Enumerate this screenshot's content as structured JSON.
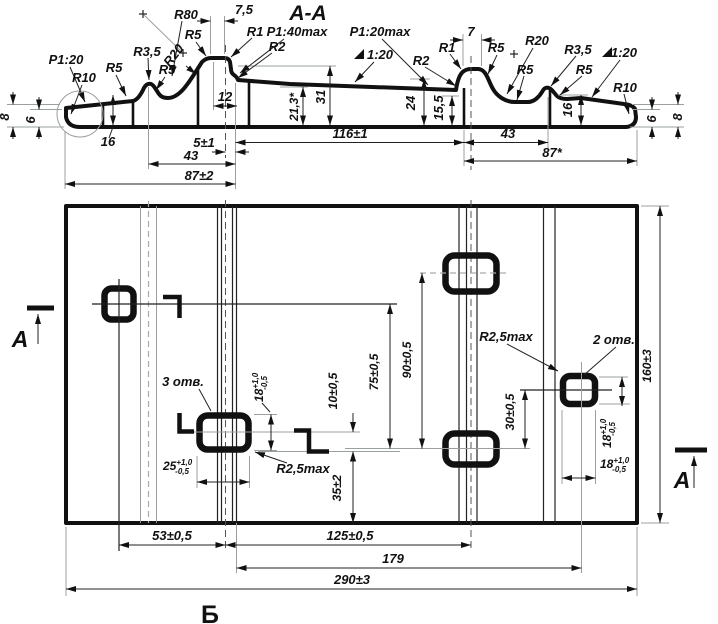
{
  "drawing": {
    "type": "engineering-drawing",
    "section_title": "A-A",
    "bottom_view_letter": "Б",
    "cut_letters": [
      "A",
      "A"
    ],
    "hole_notes": [
      "3 отв.",
      "2 отв."
    ],
    "colors": {
      "ink": "#111111",
      "gray": "#9aa0a0",
      "background": "#ffffff"
    }
  },
  "labels": [
    {
      "n": "section-title",
      "t": "A-A",
      "x": 308,
      "y": 20,
      "s": 21
    },
    {
      "n": "dim-r80",
      "t": "R80",
      "x": 186,
      "y": 19,
      "s": 13
    },
    {
      "n": "dim-7-5",
      "t": "7,5",
      "x": 244,
      "y": 14,
      "s": 13
    },
    {
      "n": "dim-r5-peak-left",
      "t": "R5",
      "x": 193,
      "y": 39,
      "s": 13
    },
    {
      "n": "dim-r1-left",
      "t": "R1",
      "x": 255,
      "y": 36,
      "s": 13
    },
    {
      "n": "dim-slope-1-40max",
      "t": "P1:40max",
      "x": 297,
      "y": 36,
      "s": 13
    },
    {
      "n": "dim-r2-left",
      "t": "R2",
      "x": 277,
      "y": 51,
      "s": 13
    },
    {
      "n": "dim-r3-5-left",
      "t": "R3,5",
      "x": 147,
      "y": 56,
      "s": 13
    },
    {
      "n": "dim-r20-left",
      "t": "R20",
      "x": 177,
      "y": 58,
      "s": 13,
      "r": -52
    },
    {
      "n": "dim-r5-left-outer",
      "t": "R5",
      "x": 114,
      "y": 72,
      "s": 13
    },
    {
      "n": "dim-r5-left-bump",
      "t": "R5",
      "x": 167,
      "y": 74,
      "s": 13
    },
    {
      "n": "dim-slope-1-20-left",
      "t": "P1:20",
      "x": 66,
      "y": 64,
      "s": 13
    },
    {
      "n": "dim-r10-left",
      "t": "R10",
      "x": 84,
      "y": 82,
      "s": 13
    },
    {
      "n": "dim-12",
      "t": "12",
      "x": 225,
      "y": 101,
      "s": 13
    },
    {
      "n": "dim-21-3",
      "t": "21,3*",
      "x": 298,
      "y": 107,
      "s": 12,
      "r": -90
    },
    {
      "n": "dim-31",
      "t": "31",
      "x": 325,
      "y": 97,
      "s": 13,
      "r": -90
    },
    {
      "n": "dim-5pm1",
      "t": "5±1",
      "x": 204,
      "y": 147,
      "s": 13
    },
    {
      "n": "dim-43-left",
      "t": "43",
      "x": 191,
      "y": 160,
      "s": 13
    },
    {
      "n": "dim-87pm2",
      "t": "87±2",
      "x": 199,
      "y": 180,
      "s": 13
    },
    {
      "n": "dim-116pm1",
      "t": "116±1",
      "x": 350,
      "y": 138,
      "s": 13
    },
    {
      "n": "dim-slope-1-20max",
      "t": "P1:20max",
      "x": 380,
      "y": 36,
      "s": 13
    },
    {
      "n": "dim-slope-left-mark",
      "t": "1:20",
      "x": 380,
      "y": 59,
      "s": 13
    },
    {
      "n": "dim-r2-right",
      "t": "R2",
      "x": 421,
      "y": 65,
      "s": 13
    },
    {
      "n": "dim-r1-right",
      "t": "R1",
      "x": 447,
      "y": 52,
      "s": 13
    },
    {
      "n": "dim-7",
      "t": "7",
      "x": 471,
      "y": 36,
      "s": 13
    },
    {
      "n": "dim-r5-hump-right",
      "t": "R5",
      "x": 496,
      "y": 52,
      "s": 13
    },
    {
      "n": "dim-r20-right",
      "t": "R20",
      "x": 537,
      "y": 45,
      "s": 13
    },
    {
      "n": "dim-r5-dip",
      "t": "R5",
      "x": 525,
      "y": 74,
      "s": 13
    },
    {
      "n": "dim-r3-5-right",
      "t": "R3,5",
      "x": 578,
      "y": 54,
      "s": 13
    },
    {
      "n": "dim-r5-right-bump",
      "t": "R5",
      "x": 584,
      "y": 74,
      "s": 13
    },
    {
      "n": "dim-slope-right-mark",
      "t": "1:20",
      "x": 624,
      "y": 57,
      "s": 13
    },
    {
      "n": "dim-r10-right",
      "t": "R10",
      "x": 625,
      "y": 92,
      "s": 13
    },
    {
      "n": "dim-24",
      "t": "24",
      "x": 415,
      "y": 103,
      "s": 13,
      "r": -90
    },
    {
      "n": "dim-15-5",
      "t": "15,5",
      "x": 443,
      "y": 108,
      "s": 13,
      "r": -90
    },
    {
      "n": "dim-16-right",
      "t": "16",
      "x": 572,
      "y": 110,
      "s": 13,
      "r": -90
    },
    {
      "n": "dim-6-right",
      "t": "6",
      "x": 656,
      "y": 119,
      "s": 13,
      "r": -90
    },
    {
      "n": "dim-8-right",
      "t": "8",
      "x": 682,
      "y": 117,
      "s": 13,
      "r": -90
    },
    {
      "n": "dim-8-left",
      "t": "8",
      "x": 9,
      "y": 117,
      "s": 13,
      "r": -90
    },
    {
      "n": "dim-6-left",
      "t": "6",
      "x": 35,
      "y": 120,
      "s": 13,
      "r": -90
    },
    {
      "n": "dim-16-left",
      "t": "16",
      "x": 108,
      "y": 146,
      "s": 13
    },
    {
      "n": "dim-43-right",
      "t": "43",
      "x": 508,
      "y": 138,
      "s": 13
    },
    {
      "n": "dim-87-ref",
      "t": "87*",
      "x": 552,
      "y": 157,
      "s": 13
    },
    {
      "n": "cut-letter-a-left",
      "t": "A",
      "x": 20,
      "y": 347,
      "s": 23
    },
    {
      "n": "cut-letter-a-right",
      "t": "A",
      "x": 682,
      "y": 488,
      "s": 23
    },
    {
      "n": "view-letter-b",
      "t": "Б",
      "x": 210,
      "y": 623,
      "s": 25,
      "i": false
    },
    {
      "n": "note-3-holes",
      "t": "3 отв.",
      "x": 183,
      "y": 386,
      "s": 13
    },
    {
      "n": "note-2-holes",
      "t": "2 отв.",
      "x": 614,
      "y": 344,
      "s": 13
    },
    {
      "n": "dim-r2-5max-center",
      "t": "R2,5max",
      "x": 303,
      "y": 473,
      "s": 13
    },
    {
      "n": "dim-r2-5max-right",
      "t": "R2,5max",
      "x": 506,
      "y": 341,
      "s": 13
    },
    {
      "n": "dim-25-tol",
      "t": "25",
      "sup": "+1,0",
      "sub": "-0,5",
      "x": 163,
      "y": 470,
      "s": 12
    },
    {
      "n": "dim-18-tol-center",
      "t": "18",
      "sup": "+1,0",
      "sub": "-0,5",
      "x": 263,
      "y": 402,
      "s": 12,
      "r": -90,
      "a": "start"
    },
    {
      "n": "dim-10pm05",
      "t": "10±0,5",
      "x": 337,
      "y": 391,
      "s": 12,
      "r": -90
    },
    {
      "n": "dim-35pm2",
      "t": "35±2",
      "x": 341,
      "y": 488,
      "s": 12,
      "r": -90
    },
    {
      "n": "dim-75pm05",
      "t": "75±0,5",
      "x": 378,
      "y": 372,
      "s": 12,
      "r": -90
    },
    {
      "n": "dim-90pm05",
      "t": "90±0,5",
      "x": 411,
      "y": 360,
      "s": 12,
      "r": -90
    },
    {
      "n": "dim-30pm05",
      "t": "30±0,5",
      "x": 514,
      "y": 412,
      "s": 12,
      "r": -90
    },
    {
      "n": "dim-18-tol-right-v",
      "t": "18",
      "sup": "+1,0",
      "sub": "-0,5",
      "x": 611,
      "y": 448,
      "s": 12,
      "r": -90,
      "a": "start"
    },
    {
      "n": "dim-18-tol-right-h",
      "t": "18",
      "sup": "+1,0",
      "sub": "-0,5",
      "x": 600,
      "y": 468,
      "s": 12
    },
    {
      "n": "dim-160pm3",
      "t": "160±3",
      "x": 651,
      "y": 366,
      "s": 12,
      "r": -90
    },
    {
      "n": "dim-53pm05",
      "t": "53±0,5",
      "x": 172,
      "y": 540,
      "s": 13
    },
    {
      "n": "dim-125pm05",
      "t": "125±0,5",
      "x": 350,
      "y": 540,
      "s": 13
    },
    {
      "n": "dim-179",
      "t": "179",
      "x": 393,
      "y": 563,
      "s": 13
    },
    {
      "n": "dim-290pm3",
      "t": "290±3",
      "x": 352,
      "y": 584,
      "s": 13
    }
  ]
}
